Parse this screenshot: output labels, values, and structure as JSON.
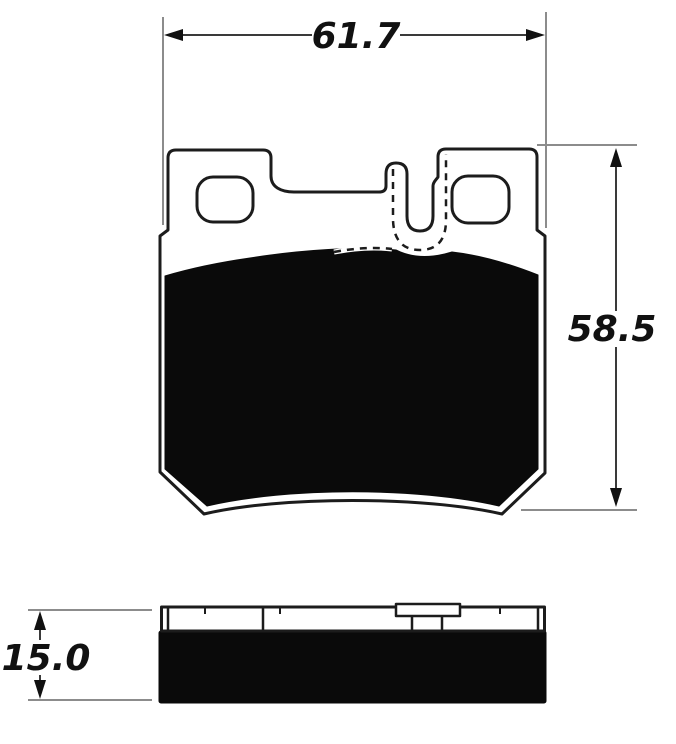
{
  "drawing": {
    "dimensions": {
      "width": {
        "label": "61.7"
      },
      "height": {
        "label": "58.5"
      },
      "thickness": {
        "label": "15.0"
      }
    },
    "colors": {
      "background": "#ffffff",
      "outline": "#1c1c1c",
      "friction_material": "#0a0a0a",
      "extension_line": "#8c8c8c",
      "dimension_line": "#3a3a3a",
      "label_text": "#111111"
    }
  }
}
